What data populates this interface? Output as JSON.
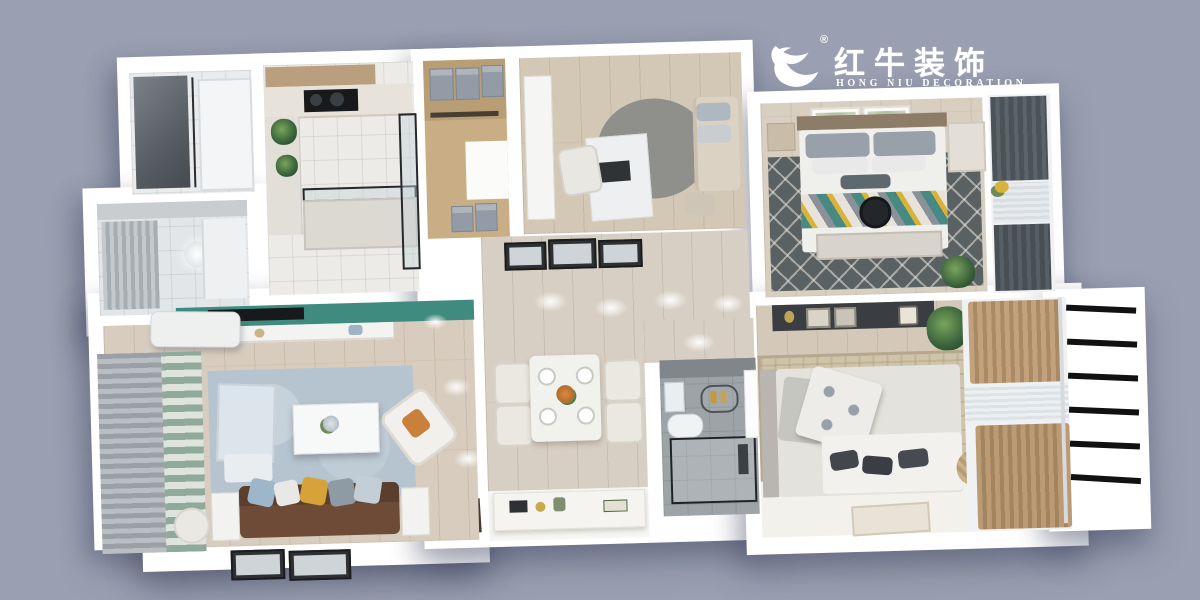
{
  "canvas": {
    "width": 1200,
    "height": 600,
    "background_color": "#9aa0b1"
  },
  "logo": {
    "registered_mark": "®",
    "brand_zh": "红牛装饰",
    "brand_en": "HONG NIU DECORATION",
    "text_color": "#ffffff",
    "icon": "bull-swoosh-icon"
  },
  "palette": {
    "wall_white": "#ffffff",
    "wood_floor": "#d6cbbc",
    "tv_wall_teal": "#3f8b80",
    "living_rug_blue": "#b5c4ce",
    "sofa_brown": "#6d4b37",
    "bedroom_rug_dark": "#5a6163",
    "throw_mosaic": [
      "#478a84",
      "#d9b23a",
      "#e7e3da",
      "#8a9198"
    ],
    "curtain_tan": "#b3946f",
    "bath_tile_dark": "#9da3a6",
    "glass_frame_black": "#26292c",
    "storage_box_gray": "#939ca6"
  },
  "scene": {
    "type": "3d-rendered-apartment-floor-plan",
    "view": "top-down",
    "rooms": [
      "bathroom-1",
      "bathroom-2",
      "kitchen",
      "entry-closet",
      "study",
      "hallway",
      "dining-area",
      "entry-area",
      "bathroom-3",
      "living-room",
      "bedroom-1",
      "bedroom-1-balcony",
      "bedroom-2",
      "bedroom-2-window-wall",
      "drying-rack"
    ]
  }
}
